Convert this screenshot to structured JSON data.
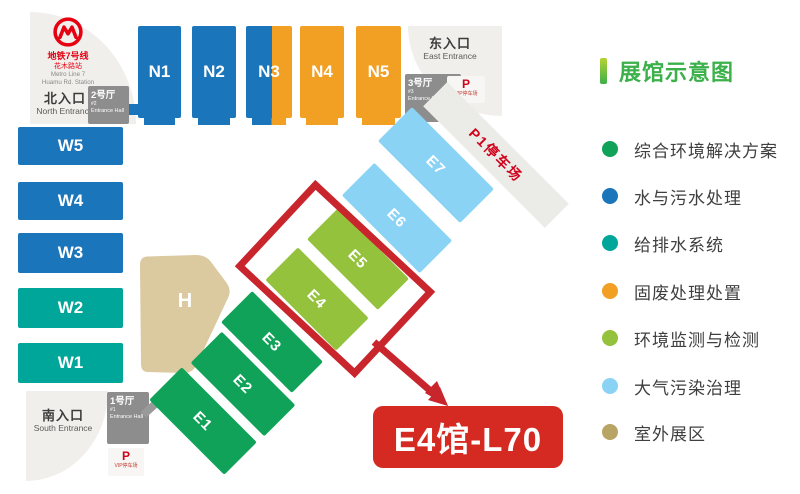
{
  "entrances": {
    "north": {
      "zh": "北入口",
      "en": "North Entrance"
    },
    "east": {
      "zh": "东入口",
      "en": "East Entrance"
    },
    "south": {
      "zh": "南入口",
      "en": "South Entrance"
    }
  },
  "metro": {
    "zh1": "地铁7号线",
    "zh2": "花木路站",
    "en1": "Metro Line 7",
    "en2": "Huamu Rd. Station"
  },
  "entrance_halls": {
    "h1": {
      "name": "1号厅",
      "no": "#1",
      "en": "Entrance Hall"
    },
    "h2": {
      "name": "2号厅",
      "no": "#2",
      "en": "Entrance Hall"
    },
    "h3": {
      "name": "3号厅",
      "no": "#3",
      "en": "Entrance Hall"
    }
  },
  "parking": {
    "vip_top": {
      "p": "P",
      "label": "VIP停车场"
    },
    "vip_bottom": {
      "p": "P",
      "label": "VIP停车场"
    },
    "p1": {
      "label": "P1停车场"
    }
  },
  "halls": {
    "n": [
      {
        "label": "N1",
        "color": "#1b75bb"
      },
      {
        "label": "N2",
        "color": "#1b75bb"
      },
      {
        "label": "N3",
        "colors": [
          "#1b75bb",
          "#f2a024"
        ]
      },
      {
        "label": "N4",
        "color": "#f2a024"
      },
      {
        "label": "N5",
        "color": "#f2a024"
      }
    ],
    "w": [
      {
        "label": "W5",
        "color": "#1b75bb"
      },
      {
        "label": "W4",
        "color": "#1b75bb"
      },
      {
        "label": "W3",
        "color": "#1b75bb"
      },
      {
        "label": "W2",
        "color": "#00a69a"
      },
      {
        "label": "W1",
        "color": "#00a69a"
      }
    ],
    "e": [
      {
        "label": "E1",
        "color": "#0fa258"
      },
      {
        "label": "E2",
        "color": "#0fa258"
      },
      {
        "label": "E3",
        "color": "#0fa258"
      },
      {
        "label": "E4",
        "color": "#95c23d"
      },
      {
        "label": "E5",
        "color": "#95c23d"
      },
      {
        "label": "E6",
        "color": "#8bd3f5"
      },
      {
        "label": "E7",
        "color": "#8bd3f5"
      }
    ],
    "h": {
      "label": "H",
      "color": "#dbc9a0"
    }
  },
  "annotation": {
    "label": "E4馆-L70",
    "highlight_hall": "E4",
    "color": "#c9252c"
  },
  "legend": {
    "title": "展馆示意图",
    "items": [
      {
        "label": "综合环境解决方案",
        "color": "#0fa258"
      },
      {
        "label": "水与污水处理",
        "color": "#1b75bb"
      },
      {
        "label": "给排水系统",
        "color": "#00a69a"
      },
      {
        "label": "固废处理处置",
        "color": "#f2a024"
      },
      {
        "label": "环境监测与检测",
        "color": "#95c23d"
      },
      {
        "label": "大气污染治理",
        "color": "#8bd3f5"
      },
      {
        "label": "室外展区",
        "color": "#b8a565"
      }
    ]
  }
}
